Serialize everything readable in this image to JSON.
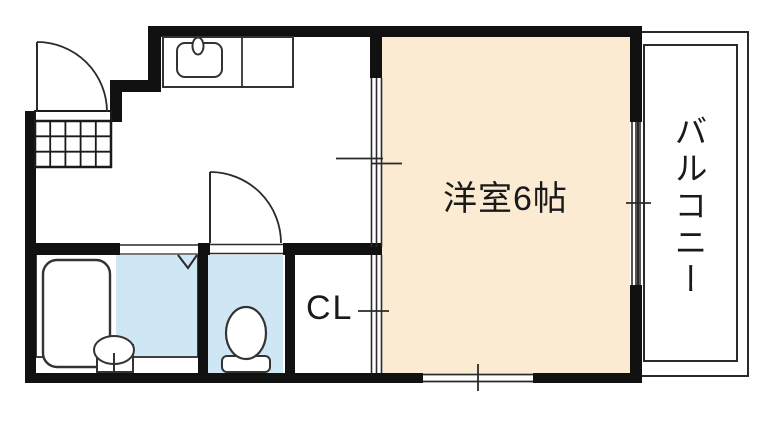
{
  "floorplan": {
    "rooms": {
      "western_room": {
        "label": "洋室6帖"
      },
      "balcony": {
        "label": "バルコニー"
      },
      "closet": {
        "label": "CL"
      }
    },
    "colors": {
      "wall": "#111111",
      "line": "#2a2a2a",
      "room_fill": "#FAEBD2",
      "wet_area_fill": "#CFE6F4",
      "background": "#FFFFFF"
    },
    "fixtures": [
      "kitchen-sink-icon",
      "bathtub-icon",
      "washbasin-icon",
      "toilet-icon",
      "entry-step-grid",
      "entrance-door-icon",
      "toilet-door-icon",
      "bath-folding-door-icon",
      "sliding-door-icon",
      "window-icon"
    ]
  }
}
